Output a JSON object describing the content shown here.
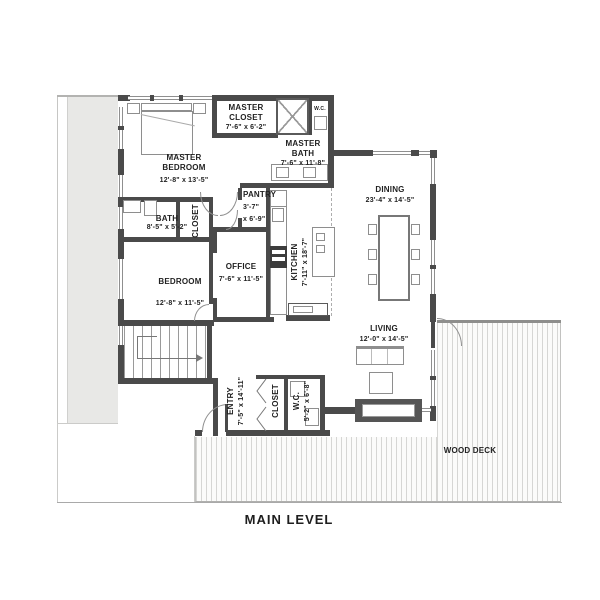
{
  "title": "MAIN LEVEL",
  "rooms": {
    "master_closet": {
      "name": "MASTER CLOSET",
      "dims": "7'-6\" x 6'-2\""
    },
    "master_bath": {
      "name": "MASTER BATH",
      "dims": "7'-6\" x 11'-8\""
    },
    "master_wc": {
      "name": "W.C."
    },
    "master_bedroom": {
      "name": "MASTER BEDROOM",
      "dims": "12'-8\" x 13'-5\""
    },
    "bath": {
      "name": "BATH",
      "dims": "8'-5\" x 5'-2\""
    },
    "master_closet2": {
      "name": "CLOSET"
    },
    "pantry": {
      "name": "PANTRY",
      "dims1": "3'-7\"",
      "dims2": "x 6'-9\""
    },
    "office": {
      "name": "OFFICE",
      "dims": "7'-6\" x 11'-5\""
    },
    "kitchen": {
      "name": "KITCHEN",
      "dims": "7'-11\" x 18'-7\""
    },
    "bedroom": {
      "name": "BEDROOM",
      "dims": "12'-8\" x 11'-5\""
    },
    "dining": {
      "name": "DINING",
      "dims": "23'-4\" x 14'-5\""
    },
    "living": {
      "name": "LIVING",
      "dims": "12'-0\" x 14'-5\""
    },
    "entry": {
      "name": "ENTRY",
      "dims": "7'-5\" x 14'-11\""
    },
    "entry_closet": {
      "name": "CLOSET"
    },
    "wc": {
      "name": "W.C.",
      "dims": "5'-2\" x 6'-8\""
    },
    "wood_deck": {
      "name": "WOOD DECK"
    }
  },
  "colors": {
    "wall": "#4a4a4a",
    "window_line": "#8f8f8f",
    "deck_line": "#d6d6d4",
    "driveway": "#e8e8e6",
    "text": "#222222"
  }
}
